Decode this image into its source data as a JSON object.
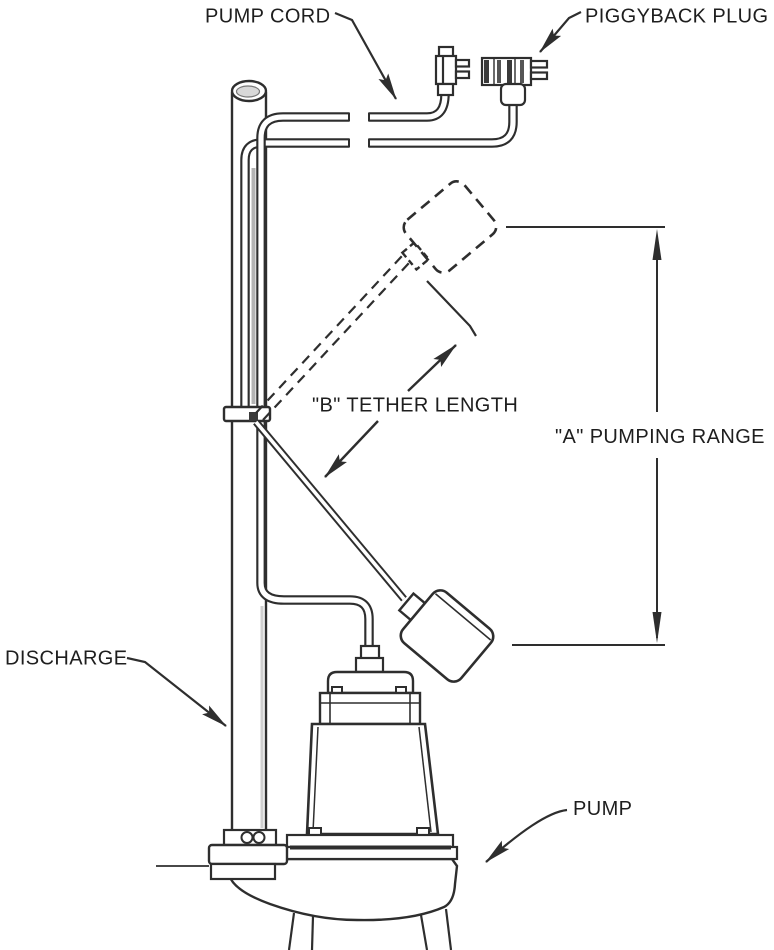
{
  "figure": {
    "labels": {
      "pump_cord": "PUMP CORD",
      "piggyback_plug": "PIGGYBACK PLUG",
      "tether_length": "\"B\" TETHER LENGTH",
      "pumping_range": "\"A\" PUMPING RANGE",
      "discharge": "DISCHARGE",
      "pump": "PUMP"
    },
    "colors": {
      "background": "#ffffff",
      "line": "#2e2e2e",
      "text": "#1e1e1e"
    }
  }
}
